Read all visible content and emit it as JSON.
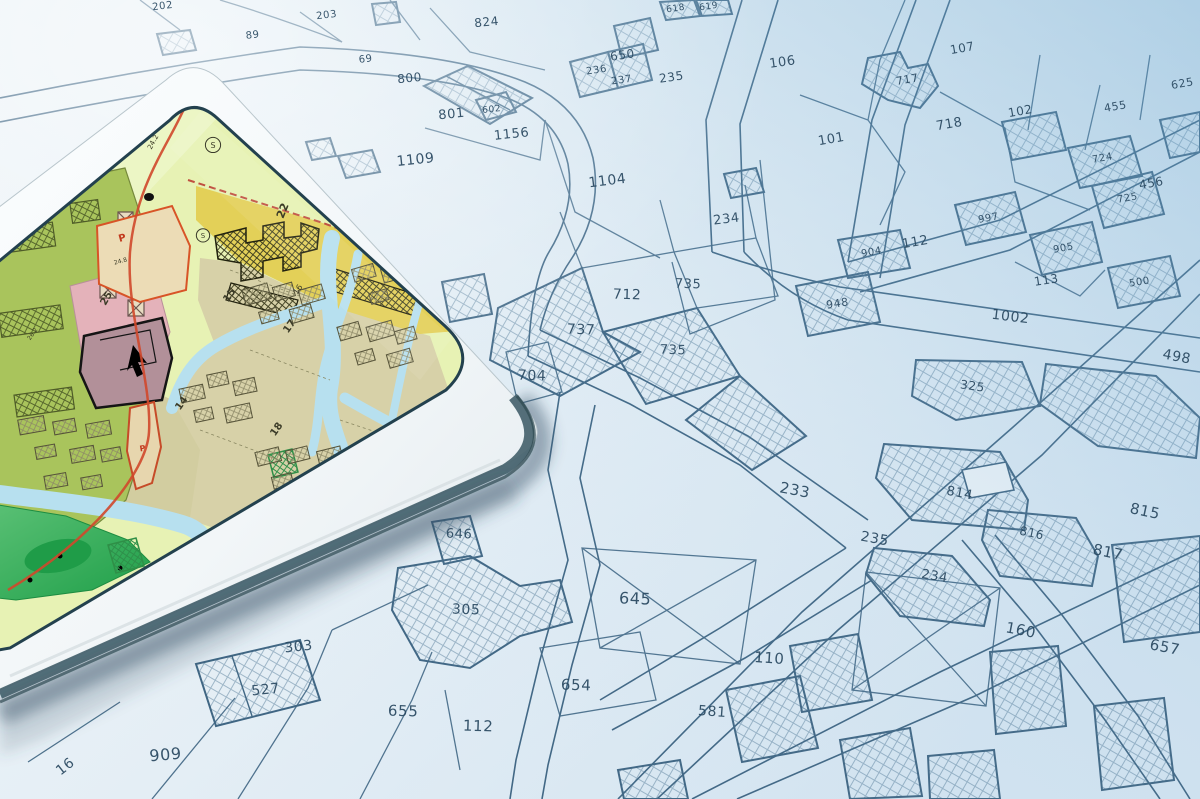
{
  "background_map": {
    "paper_color": "#e9f1f6",
    "line_color": "#3b6280",
    "label_color": "#2a4961",
    "hatch_color": "#3f6a8a",
    "parcel_labels": [
      {
        "t": "202",
        "x": 163,
        "y": 9,
        "r": -7,
        "s": 10
      },
      {
        "t": "203",
        "x": 327,
        "y": 18,
        "r": -7,
        "s": 10
      },
      {
        "t": "89",
        "x": 253,
        "y": 38,
        "r": -7,
        "s": 10
      },
      {
        "t": "69",
        "x": 366,
        "y": 62,
        "r": -7,
        "s": 10
      },
      {
        "t": "824",
        "x": 487,
        "y": 26,
        "r": -6,
        "s": 12
      },
      {
        "t": "800",
        "x": 410,
        "y": 82,
        "r": -6,
        "s": 12
      },
      {
        "t": "801",
        "x": 452,
        "y": 118,
        "r": -6,
        "s": 13
      },
      {
        "t": "602",
        "x": 492,
        "y": 112,
        "r": -6,
        "s": 9
      },
      {
        "t": "1156",
        "x": 512,
        "y": 138,
        "r": -6,
        "s": 13
      },
      {
        "t": "1109",
        "x": 416,
        "y": 164,
        "r": -6,
        "s": 14
      },
      {
        "t": "650",
        "x": 623,
        "y": 59,
        "r": -8,
        "s": 12
      },
      {
        "t": "236",
        "x": 597,
        "y": 73,
        "r": -8,
        "s": 10
      },
      {
        "t": "237",
        "x": 622,
        "y": 83,
        "r": -8,
        "s": 10
      },
      {
        "t": "618",
        "x": 676,
        "y": 11,
        "r": -8,
        "s": 9
      },
      {
        "t": "619",
        "x": 709,
        "y": 9,
        "r": -8,
        "s": 9
      },
      {
        "t": "235",
        "x": 672,
        "y": 81,
        "r": -8,
        "s": 12
      },
      {
        "t": "106",
        "x": 783,
        "y": 66,
        "r": -8,
        "s": 13
      },
      {
        "t": "1104",
        "x": 608,
        "y": 185,
        "r": -7,
        "s": 14
      },
      {
        "t": "234",
        "x": 727,
        "y": 223,
        "r": -7,
        "s": 13
      },
      {
        "t": "107",
        "x": 963,
        "y": 52,
        "r": -10,
        "s": 12
      },
      {
        "t": "717",
        "x": 908,
        "y": 83,
        "r": -10,
        "s": 11
      },
      {
        "t": "718",
        "x": 950,
        "y": 128,
        "r": -10,
        "s": 13
      },
      {
        "t": "102",
        "x": 1021,
        "y": 115,
        "r": -10,
        "s": 12
      },
      {
        "t": "101",
        "x": 832,
        "y": 143,
        "r": -10,
        "s": 13
      },
      {
        "t": "455",
        "x": 1116,
        "y": 110,
        "r": -10,
        "s": 11
      },
      {
        "t": "625",
        "x": 1183,
        "y": 87,
        "r": -10,
        "s": 11
      },
      {
        "t": "456",
        "x": 1152,
        "y": 187,
        "r": -10,
        "s": 12
      },
      {
        "t": "724",
        "x": 1103,
        "y": 161,
        "r": -10,
        "s": 10
      },
      {
        "t": "725",
        "x": 1128,
        "y": 201,
        "r": -10,
        "s": 10
      },
      {
        "t": "904",
        "x": 872,
        "y": 255,
        "r": -10,
        "s": 10
      },
      {
        "t": "997",
        "x": 989,
        "y": 221,
        "r": -10,
        "s": 10
      },
      {
        "t": "905",
        "x": 1064,
        "y": 251,
        "r": -10,
        "s": 10
      },
      {
        "t": "112",
        "x": 916,
        "y": 246,
        "r": -10,
        "s": 13
      },
      {
        "t": "113",
        "x": 1047,
        "y": 284,
        "r": -9,
        "s": 12
      },
      {
        "t": "500",
        "x": 1140,
        "y": 285,
        "r": -9,
        "s": 10
      },
      {
        "t": "948",
        "x": 838,
        "y": 307,
        "r": -9,
        "s": 11
      },
      {
        "t": "1002",
        "x": 1010,
        "y": 321,
        "r": 7,
        "s": 14
      },
      {
        "t": "498",
        "x": 1176,
        "y": 361,
        "r": 11,
        "s": 14
      },
      {
        "t": "325",
        "x": 972,
        "y": 390,
        "r": 8,
        "s": 12
      },
      {
        "t": "712",
        "x": 627,
        "y": 299,
        "r": 2,
        "s": 14
      },
      {
        "t": "737",
        "x": 581,
        "y": 334,
        "r": 2,
        "s": 14
      },
      {
        "t": "735",
        "x": 688,
        "y": 288,
        "r": 2,
        "s": 13
      },
      {
        "t": "735",
        "x": 673,
        "y": 354,
        "r": 2,
        "s": 13
      },
      {
        "t": "704",
        "x": 532,
        "y": 380,
        "r": 2,
        "s": 14
      },
      {
        "t": "233",
        "x": 794,
        "y": 495,
        "r": 11,
        "s": 15
      },
      {
        "t": "814",
        "x": 959,
        "y": 497,
        "r": 11,
        "s": 13
      },
      {
        "t": "815",
        "x": 1144,
        "y": 516,
        "r": 12,
        "s": 15
      },
      {
        "t": "816",
        "x": 1031,
        "y": 537,
        "r": 12,
        "s": 12
      },
      {
        "t": "817",
        "x": 1107,
        "y": 557,
        "r": 12,
        "s": 15
      },
      {
        "t": "235",
        "x": 874,
        "y": 543,
        "r": 10,
        "s": 14
      },
      {
        "t": "234",
        "x": 934,
        "y": 580,
        "r": 10,
        "s": 13
      },
      {
        "t": "160",
        "x": 1020,
        "y": 635,
        "r": 11,
        "s": 15
      },
      {
        "t": "657",
        "x": 1164,
        "y": 652,
        "r": 11,
        "s": 15
      },
      {
        "t": "646",
        "x": 459,
        "y": 538,
        "r": 2,
        "s": 13
      },
      {
        "t": "305",
        "x": 466,
        "y": 614,
        "r": 2,
        "s": 14
      },
      {
        "t": "645",
        "x": 635,
        "y": 604,
        "r": 2,
        "s": 16
      },
      {
        "t": "654",
        "x": 576,
        "y": 690,
        "r": 2,
        "s": 15
      },
      {
        "t": "655",
        "x": 403,
        "y": 716,
        "r": 2,
        "s": 15
      },
      {
        "t": "112",
        "x": 478,
        "y": 731,
        "r": 2,
        "s": 15
      },
      {
        "t": "110",
        "x": 769,
        "y": 663,
        "r": 4,
        "s": 15
      },
      {
        "t": "581",
        "x": 712,
        "y": 716,
        "r": 4,
        "s": 14
      },
      {
        "t": "303",
        "x": 299,
        "y": 651,
        "r": -6,
        "s": 14
      },
      {
        "t": "527",
        "x": 266,
        "y": 694,
        "r": -6,
        "s": 14
      },
      {
        "t": "909",
        "x": 166,
        "y": 760,
        "r": -5,
        "s": 16
      },
      {
        "t": "16",
        "x": 68,
        "y": 770,
        "r": -38,
        "s": 14
      }
    ]
  },
  "tablet": {
    "body_color": "#f6f9fa",
    "edge_color": "#47636e",
    "screen": {
      "base_color": "#e7f2b4",
      "water_color": "#b7e0ef",
      "zone_colors": {
        "olive_green": "#a9c45c",
        "yellow": "#e2ce55",
        "pink": "#e4b2ba",
        "purple": "#b29099",
        "tan": "#d7d1a8",
        "tan_dark": "#d2cda0",
        "park_green": "#25a34f",
        "parcel_beige": "#ecdcb6",
        "outline_red": "#d85427"
      },
      "zone_labels": [
        {
          "t": "24.2",
          "x": 155,
          "y": 143,
          "r": -62,
          "s": 7
        },
        {
          "t": "S",
          "x": 213,
          "y": 148,
          "r": 0,
          "s": 8,
          "circle": true
        },
        {
          "t": "22",
          "x": 286,
          "y": 212,
          "r": -68,
          "s": 11,
          "b": true
        },
        {
          "t": "S",
          "x": 203,
          "y": 238,
          "r": 0,
          "s": 7,
          "circle": true
        },
        {
          "t": "P",
          "x": 123,
          "y": 241,
          "r": -15,
          "s": 10,
          "c": "red"
        },
        {
          "t": "24.8",
          "x": 121,
          "y": 263,
          "r": -15,
          "s": 6
        },
        {
          "t": "25",
          "x": 109,
          "y": 300,
          "r": -60,
          "s": 10,
          "b": true
        },
        {
          "t": "15",
          "x": 232,
          "y": 297,
          "r": -55,
          "s": 10,
          "b": true
        },
        {
          "t": "16",
          "x": 300,
          "y": 291,
          "r": -55,
          "s": 8
        },
        {
          "t": "17",
          "x": 292,
          "y": 328,
          "r": -55,
          "s": 10,
          "b": true
        },
        {
          "t": "26.2",
          "x": 34,
          "y": 335,
          "r": -55,
          "s": 6
        },
        {
          "t": "14",
          "x": 184,
          "y": 405,
          "r": -55,
          "s": 10,
          "b": true
        },
        {
          "t": "18",
          "x": 279,
          "y": 431,
          "r": -55,
          "s": 10,
          "b": true
        },
        {
          "t": "P",
          "x": 143,
          "y": 451,
          "r": -10,
          "s": 8,
          "c": "red"
        }
      ]
    }
  }
}
